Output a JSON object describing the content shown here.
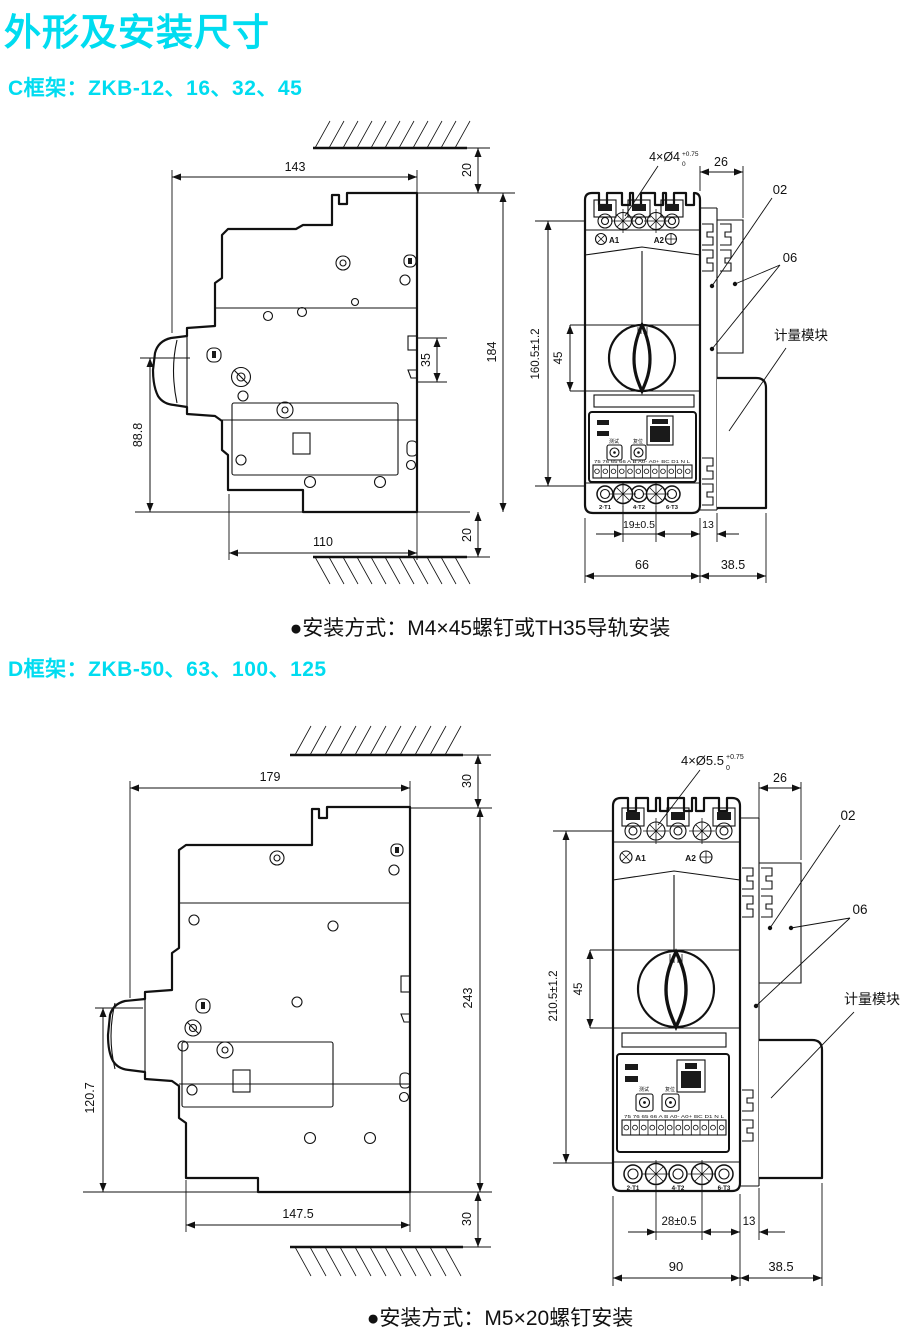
{
  "page": {
    "title": "外形及安装尺寸",
    "accent": "#00dcf0"
  },
  "frame_c": {
    "heading": "C框架：ZKB-12、16、32、45",
    "mounting_note": "●安装方式：M4×45螺钉或TH35导轨安装",
    "side_view": {
      "width_top": "143",
      "top_gap": "20",
      "height_total": "184",
      "slot_height": "35",
      "front_height": "88.8",
      "width_bottom": "110",
      "bottom_gap": "20"
    },
    "front_view": {
      "holes_label": "4×Ø4",
      "holes_tol_upper": "+0.75",
      "holes_tol_lower": "0",
      "depth_top": "26",
      "callout_02": "02",
      "callout_06": "06",
      "metering_module": "计量模块",
      "coil_a1": "A1",
      "coil_a2": "A2",
      "height": "160.5±1.2",
      "handle_height": "45",
      "terminal_pitch": "19±0.5",
      "rail_width": "13",
      "body_width": "66",
      "module_width": "38.5",
      "terminal_1": "2·T1",
      "terminal_2": "4·T2",
      "terminal_3": "6·T3",
      "test_button": "测试",
      "reset_button": "复位",
      "terminal_strip": "75 76 65 66 A B A0- A0+ BC D1 N L"
    }
  },
  "frame_d": {
    "heading": "D框架：ZKB-50、63、100、125",
    "mounting_note": "●安装方式：M5×20螺钉安装",
    "side_view": {
      "width_top": "179",
      "top_gap": "30",
      "height_total": "243",
      "front_height": "120.7",
      "width_bottom": "147.5",
      "bottom_gap": "30"
    },
    "front_view": {
      "holes_label": "4×Ø5.5",
      "holes_tol_upper": "+0.75",
      "holes_tol_lower": "0",
      "depth_top": "26",
      "callout_02": "02",
      "callout_06": "06",
      "metering_module": "计量模块",
      "coil_a1": "A1",
      "coil_a2": "A2",
      "height": "210.5±1.2",
      "handle_height": "45",
      "terminal_pitch": "28±0.5",
      "rail_width": "13",
      "body_width": "90",
      "module_width": "38.5",
      "terminal_1": "2·T1",
      "terminal_2": "4·T2",
      "terminal_3": "6·T3",
      "test_button": "测试",
      "reset_button": "复位",
      "terminal_strip": "75 76 65 66 A B A0- A0+ BC D1 N L"
    }
  }
}
